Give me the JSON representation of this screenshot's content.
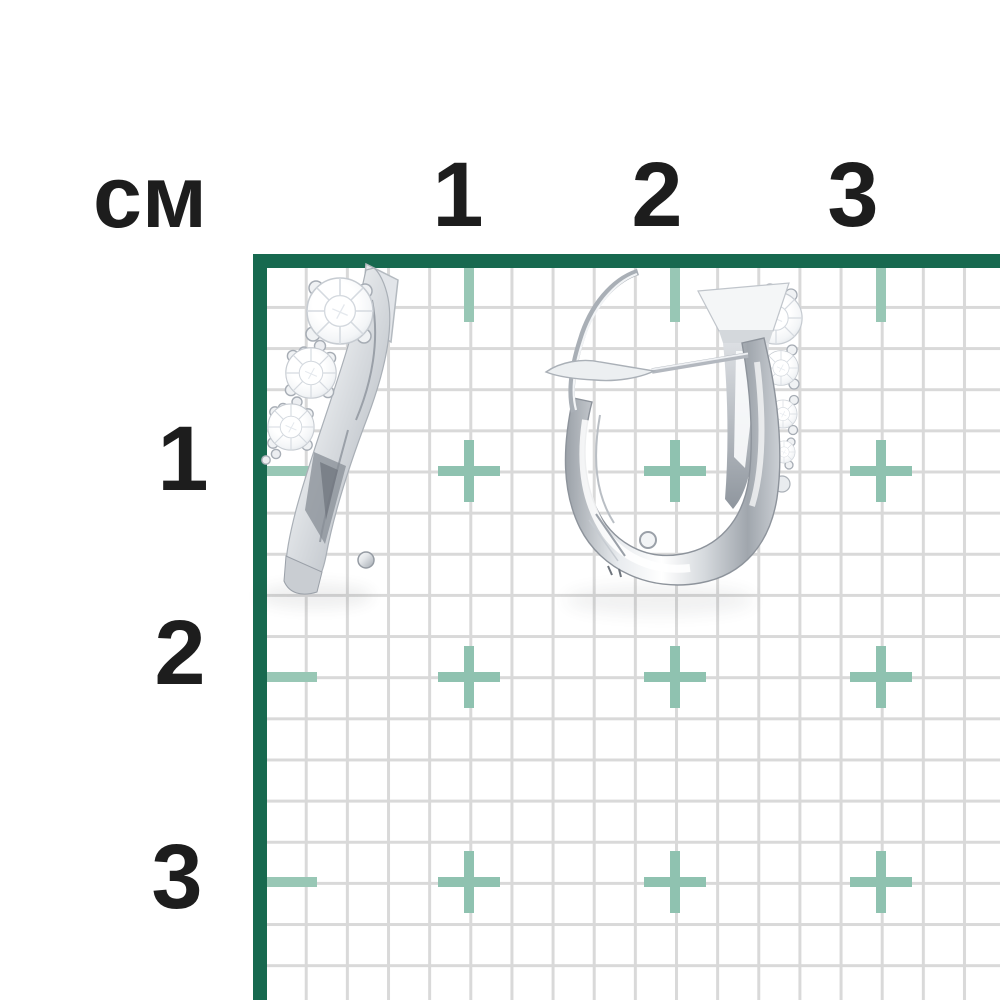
{
  "ruler": {
    "unit_label": "см",
    "unit": "cm",
    "visible_range_cm": 3,
    "top_labels": [
      "1",
      "2",
      "3"
    ],
    "side_labels": [
      "1",
      "2",
      "3"
    ],
    "colors": {
      "frame": "#17694f",
      "marker": "#8fc2b0",
      "grid_line": "#d9d9d9",
      "label_text": "#1d1d1d",
      "background": "#ffffff"
    }
  },
  "content": {
    "subject": "pair of white gold diamond earrings on centimeter grid",
    "items": [
      {
        "name": "three-stone-diamond-earring-back-view"
      },
      {
        "name": "english-lock-diamond-earring-side-view"
      }
    ],
    "metal_color": "#dfe3e7"
  }
}
